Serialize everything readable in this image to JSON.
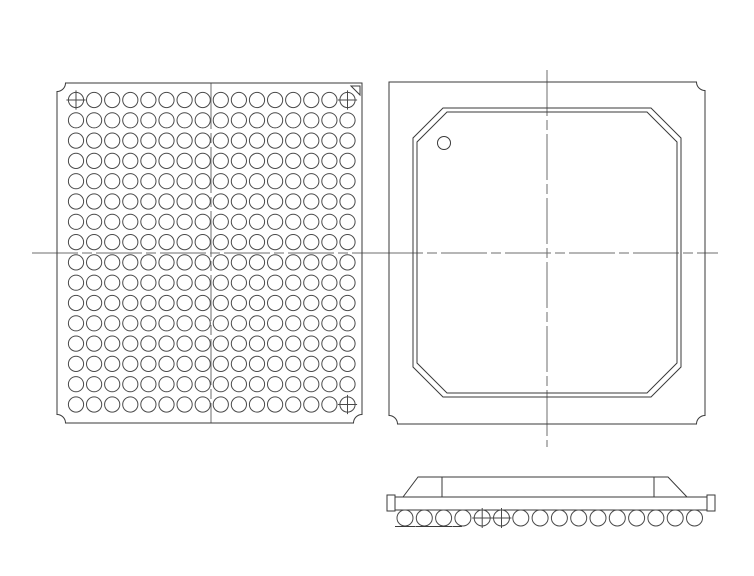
{
  "figure": {
    "description": "BGA package outline drawing with bottom view ball grid, top view mold cap, and side profile",
    "background": "#ffffff",
    "stroke_color": "#3a3a3a",
    "ball_stroke_color": "#4a4a4a",
    "centerline_color": "#6e6e6e",
    "canvas": {
      "width": 754,
      "height": 576
    }
  },
  "bottom_view": {
    "frame": {
      "x": 57,
      "y": 83,
      "width": 305,
      "height": 340
    },
    "corner_notch_radius": 8.5,
    "pin1_corner": "top-right",
    "pin1_triangle": {
      "points": "351,86 360,86 360,95"
    },
    "ball_grid": {
      "rows": 16,
      "cols": 16,
      "first_center": {
        "x": 76,
        "y": 100
      },
      "pitch": {
        "x": 18.1,
        "y": 20.3
      },
      "ball_radius": 7.6,
      "crosshair_balls": [
        {
          "row": 0,
          "col": 0
        },
        {
          "row": 0,
          "col": 15
        },
        {
          "row": 15,
          "col": 15
        }
      ]
    },
    "centerlines": {
      "vertical": {
        "x": 211,
        "y1": 83,
        "y2": 423
      },
      "horizontal": {
        "y": 253,
        "x1": 32,
        "x2": 377
      }
    }
  },
  "top_view": {
    "frame": {
      "x": 389,
      "y": 82,
      "width": 316,
      "height": 342
    },
    "corner_notch_radius": 8.5,
    "pin1_corner": "top-left",
    "mold_cap": {
      "outer": {
        "left": 413,
        "top": 108,
        "right": 681,
        "bottom": 397,
        "chamfer": 30
      },
      "inner_offset": 4
    },
    "pin1_dot": {
      "cx": 444,
      "cy": 143,
      "r": 6.5
    },
    "centerlines": {
      "vertical": {
        "x": 547,
        "y1": 70,
        "y2": 447
      },
      "horizontal": {
        "y": 253,
        "x1": 377,
        "x2": 718
      }
    }
  },
  "side_view": {
    "substrate": {
      "x": 395,
      "y": 497,
      "width": 312,
      "height": 13
    },
    "left_tab": {
      "x": 387,
      "y": 495,
      "width": 8,
      "height": 16
    },
    "right_tab": {
      "x": 707,
      "y": 495,
      "width": 8,
      "height": 16
    },
    "mold_cap": {
      "base_left": 403,
      "top_left": 418,
      "top_right": 668,
      "base_right": 687,
      "top_y": 477,
      "base_y": 497,
      "chamfer_edge_lines_x": [
        442,
        654
      ]
    },
    "balls": {
      "count": 16,
      "first_cx": 405,
      "cy": 518,
      "pitch": 19.3,
      "radius": 8,
      "crosshair_indices": [
        4,
        5
      ],
      "underlines": [
        {
          "index": 0,
          "x1_offset": -10,
          "x2_offset": 10
        },
        {
          "index": 1,
          "x1_offset": -9,
          "x2_offset": 11
        },
        {
          "index": 2,
          "x1_offset": -10,
          "x2_offset": 9
        },
        {
          "index": 3,
          "x1_offset": -10,
          "x2_offset": -1
        }
      ],
      "underline_y": 526.5
    }
  }
}
